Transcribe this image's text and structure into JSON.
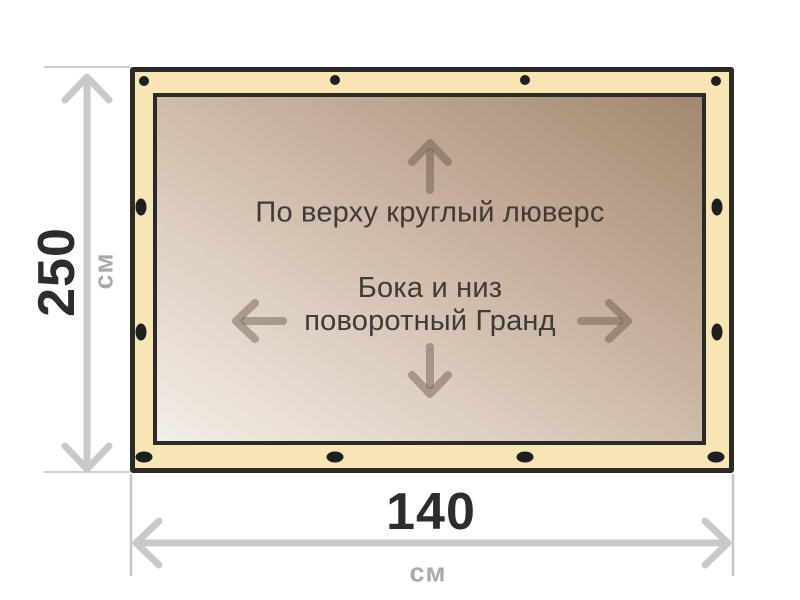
{
  "diagram": {
    "type": "tarp-size-diagram",
    "tarp": {
      "top_note": "По верху круглый люверс",
      "center_note_line1": "Бока и низ",
      "center_note_line2": "поворотный Гранд",
      "grommets": {
        "top_edge_shape": "round",
        "side_edge_shape": "vertical-oval",
        "bottom_edge_shape": "horizontal-oval",
        "count": 12
      }
    },
    "dimensions": {
      "height": {
        "value": "250",
        "unit": "см"
      },
      "width": {
        "value": "140",
        "unit": "см"
      }
    },
    "colors": {
      "background": "#ffffff",
      "tarp_edge": "#f7e5b5",
      "tarp_outline": "#2b2a27",
      "canvas_light": "#f3eee8",
      "canvas_dark": "#a28870",
      "grommet": "#1f1f1f",
      "dimension_arrow": "#c9c9c9",
      "dimension_number": "#2d2d2d",
      "dimension_unit": "#aaaaaa",
      "inner_arrow": "rgba(94,76,60,0.42)",
      "note_text": "#3e3a36"
    }
  }
}
